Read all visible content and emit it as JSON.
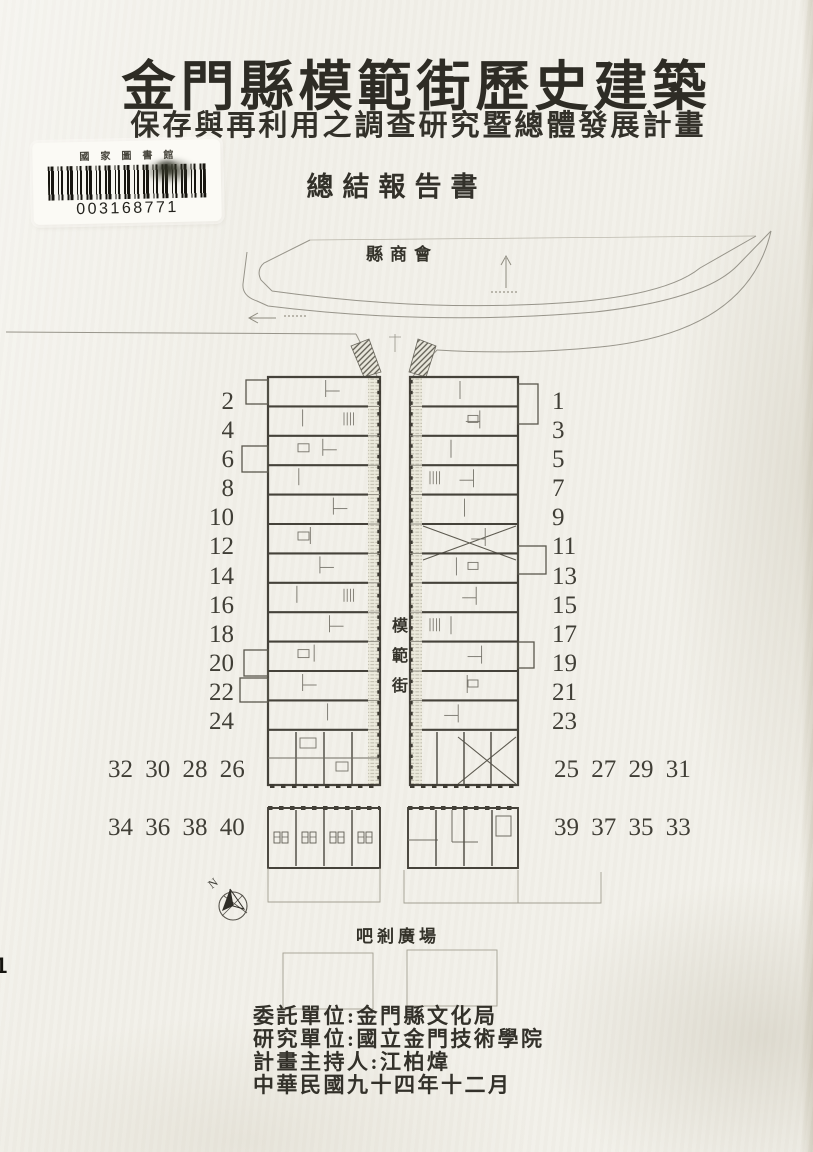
{
  "page": {
    "paper_color": "#f1efe8",
    "ink_color": "#2e2c25",
    "edge_mark": "1"
  },
  "header": {
    "title": "金門縣模範街歷史建築",
    "subtitle": "保存與再利用之調查研究暨總體發展計畫",
    "report_type": "總結報告書"
  },
  "library_sticker": {
    "institution": "國家圖書館",
    "barcode_number": "003168771"
  },
  "map": {
    "north_label": "N",
    "top_area_label": "縣商會",
    "street_name": "模範街",
    "plaza_label": "吧剎廣場",
    "left_numbers": [
      "2",
      "4",
      "6",
      "8",
      "10",
      "12",
      "14",
      "16",
      "18",
      "20",
      "22",
      "24"
    ],
    "right_numbers": [
      "1",
      "3",
      "5",
      "7",
      "9",
      "11",
      "13",
      "15",
      "17",
      "19",
      "21",
      "23"
    ],
    "bottom_left_row1": "32 30 28 26",
    "bottom_right_row1": "25 27 29 31",
    "bottom_left_row2": "34 36 38 40",
    "bottom_right_row2": "39 37 35 33"
  },
  "credits": {
    "lines": [
      "委託單位:金門縣文化局",
      "研究單位:國立金門技術學院",
      "計畫主持人:江柏煒",
      "中華民國九十四年十二月"
    ]
  }
}
